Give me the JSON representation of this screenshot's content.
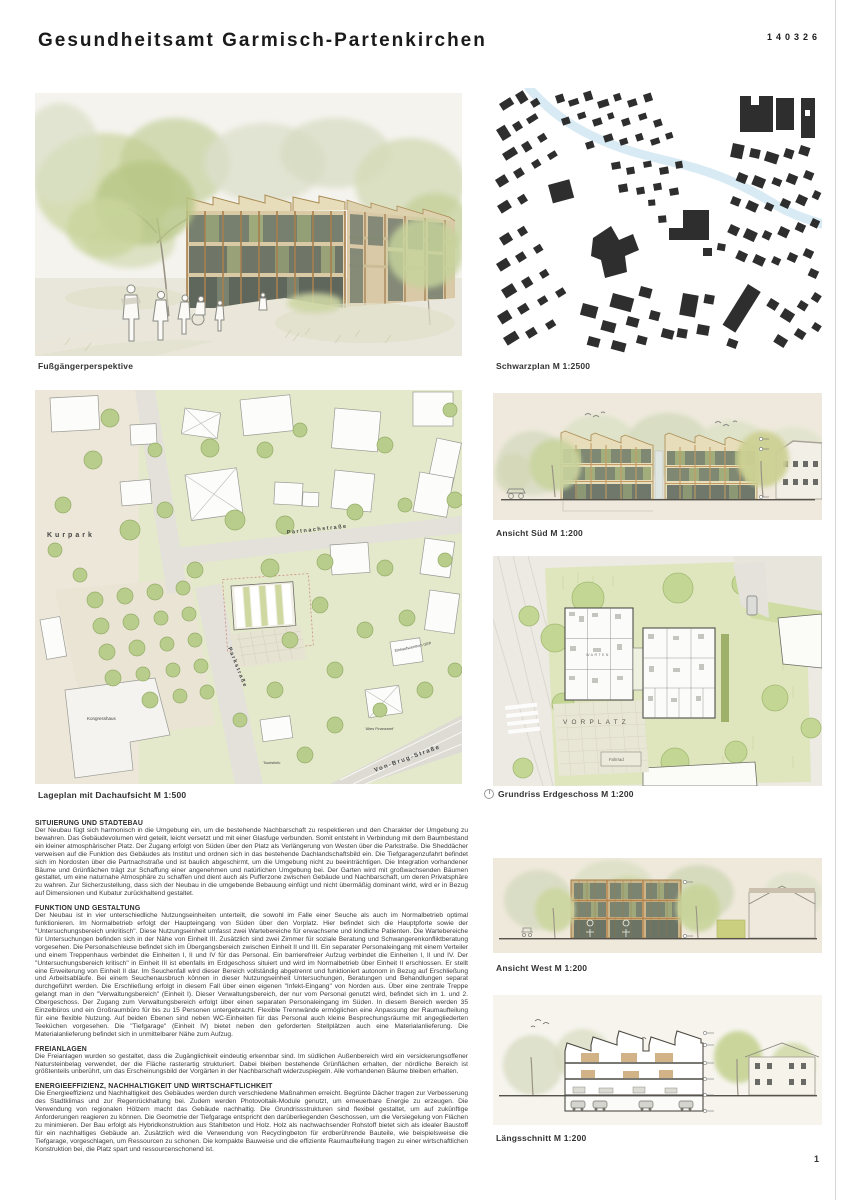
{
  "header": {
    "title": "Gesundheitsamt Garmisch-Partenkirchen",
    "code": "140326"
  },
  "page_number": "1",
  "figures": {
    "perspective": {
      "caption": "Fußgängerperspektive"
    },
    "schwarzplan": {
      "caption": "Schwarzplan M 1:2500"
    },
    "lageplan": {
      "caption": "Lageplan mit Dachaufsicht M 1:500",
      "labels": {
        "kurpark": "Kurpark",
        "partnachstrasse": "Partnachstraße",
        "parkstrasse": "Parkstraße",
        "kongresshaus": "Kongresshaus",
        "von_brug_strasse": "Von-Brug-Straße",
        "einkaufszentrum": "Einkaufszentrum GEP",
        "touristinfo": "Touristinfo",
        "altes_finanzamt": "'Altes Finanzamt'"
      }
    },
    "ansicht_sued": {
      "caption": "Ansicht Süd M 1:200"
    },
    "grundriss": {
      "caption": "Grundriss Erdgeschoss M 1:200",
      "labels": {
        "vorplatz": "VORPLATZ",
        "fahrrad": "Fahrrad",
        "warten": "WARTEN"
      }
    },
    "ansicht_west": {
      "caption": "Ansicht West M 1:200"
    },
    "laengsschnitt": {
      "caption": "Längsschnitt M 1:200"
    }
  },
  "sections": [
    {
      "heading": "SITUIERUNG UND STADTEBAU",
      "body": "Der Neubau fügt sich harmonisch in die Umgebung ein, um die bestehende Nachbarschaft zu respektieren und den Charakter der Umgebung zu bewahren. Das Gebäudevolumen wird geteilt, leicht versetzt und mit einer Glasfuge verbunden. Somit entsteht in Verbindung mit dem Baumbestand ein kleiner atmosphärischer Platz. Der Zugang erfolgt von Süden über den Platz als Verlängerung von Westen über die Parkstraße. Die Sheddächer verweisen auf die Funktion des Gebäudes als Institut und ordnen sich in das bestehende Dachlandschaftsbild ein. Die Tiefgaragenzufahrt befindet sich im Nordosten über die Partnachstraße und ist baulich abgeschirmt, um die Umgebung nicht zu beeinträchtigen. Die Integration vorhandener Bäume und Grünflächen trägt zur Schaffung einer angenehmen und natürlichen Umgebung bei. Der Garten wird mit großwachsenden Bäumen gestaltet, um eine naturnahe Atmosphäre zu schaffen und dient auch als Pufferzone zwischen Gebäude und Nachbarschaft, um deren Privatsphäre zu wahren. Zur Sicherzustellung, dass sich der Neubau in die umgebende Bebauung einfügt und nicht übermäßig dominant wirkt, wird er in Bezug auf Dimensionen und Kubatur zurückhaltend gestaltet."
    },
    {
      "heading": "FUNKTION UND GESTALTUNG",
      "body": "Der Neubau ist in vier unterschiedliche Nutzungseinheiten unterteilt, die sowohl im Falle einer Seuche als auch im Normalbetrieb optimal funktionieren. Im Normalbetrieb erfolgt der Haupteingang von Süden über den Vorplatz. Hier befindet sich die Hauptpforte sowie der \"Untersuchungsbereich unkritisch\". Diese Nutzungseinheit umfasst zwei Wartebereiche für erwachsene und kindliche Patienten. Die Wartebereiche für Untersuchungen befinden sich in der Nähe von Einheit III. Zusätzlich sind zwei Zimmer für soziale Beratung und Schwangerenkonfliktberatung vorgesehen. Die Personalschleuse befindet sich im Übergangsbereich zwischen Einheit II und III. Ein separater Personaleingang mit einem Verteiler und einem Treppenhaus verbindet die Einheiten I, II und IV für das Personal. Ein barrierefreier Aufzug verbindet die Einheiten I, II und IV. Der \"Untersuchungsbereich kritisch\" in Einheit III ist ebenfalls im Erdgeschoss situiert und wird im Normalbetrieb über Einheit II erschlossen. Er stellt eine Erweiterung von Einheit II dar. Im Seuchenfall wird dieser Bereich vollständig abgetrennt und funktioniert autonom in Bezug auf Erschließung und Arbeitsabläufe. Bei einem Seuchenausbruch können in dieser Nutzungseinheit Untersuchungen, Beratungen und Behandlungen separat durchgeführt werden. Die Erschließung erfolgt in diesem Fall über einen eigenen \"Infekt-Eingang\" von Norden aus. Über eine zentrale Treppe gelangt man in den \"Verwaltungsbereich\" (Einheit I). Dieser Verwaltungsbereich, der nur vom Personal genutzt wird, befindet sich im 1. und 2. Obergeschoss. Der Zugang zum Verwaltungsbereich erfolgt über einen separaten Personaleingang im Süden. In diesem Bereich werden 35 Einzelbüros und ein Großraumbüro für bis zu 15 Personen untergebracht. Flexible Trennwände ermöglichen eine Anpassung der Raumaufteilung für eine flexible Nutzung. Auf beiden Ebenen sind neben WC-Einheiten für das Personal auch kleine Besprechungsräume mit angegliederten Teeküchen vorgesehen. Die \"Tiefgarage\" (Einheit IV) bietet neben den geforderten Stellplätzen auch eine Materialanlieferung. Die Materialanlieferung befindet sich in unmittelbarer Nähe zum Aufzug."
    },
    {
      "heading": "FREIANLAGEN",
      "body": "Die Freianlagen wurden so gestaltet, dass die Zugänglichkeit eindeutig erkennbar sind. Im südlichen Außenbereich wird ein versickerungsoffener Natursteinbelag verwendet, der die Fläche rasterartig strukturiert. Dabei bleiben bestehende Grünflächen erhalten, der nördliche Bereich ist größtenteils unberührt, um das Erscheinungsbild der Vorgärten in der Nachbarschaft widerzuspiegeln. Alle vorhandenen Bäume bleiben erhalten."
    },
    {
      "heading": "ENERGIEEFFIZIENZ, NACHHALTIGKEIT UND WIRTSCHAFTLICHKEIT",
      "body": "Die Energieeffizienz und Nachhaltigkeit des Gebäudes werden durch verschiedene Maßnahmen erreicht. Begrünte Dächer tragen zur Verbesserung des Stadtklimas und zur Regenrückhaltung bei. Zudem werden Photovoltaik-Module genutzt, um erneuerbare Energie zu erzeugen. Die Verwendung von regionalen Hölzern macht das Gebäude nachhaltig. Die Grundrissstrukturen sind flexibel gestaltet, um auf zukünftige Anforderungen reagieren zu können. Die Geometrie der Tiefgarage entspricht den darüberliegenden Geschossen, um die Versiegelung von Flächen zu minimieren. Der Bau erfolgt als Hybridkonstruktion aus Stahlbeton und Holz. Holz als nachwachsender Rohstoff bietet sich als idealer Baustoff für ein nachhaltiges Gebäude an. Zusätzlich wird die Verwendung von Recyclingbeton für erdberührende Bauteile, wie beispielsweise die Tiefgarage, vorgeschlagen, um Ressourcen zu schonen. Die kompakte Bauweise und die effiziente Raumaufteilung tragen zu einer wirtschaftlichen Konstruktion bei, die Platz spart und ressourcenschonend ist."
    }
  ],
  "colors": {
    "river": "#d8eaf4",
    "black_buildings": "#2e2e2e",
    "greenery": "#b8cc8c",
    "wood": "#b08a58",
    "paper": "#ffffff"
  }
}
